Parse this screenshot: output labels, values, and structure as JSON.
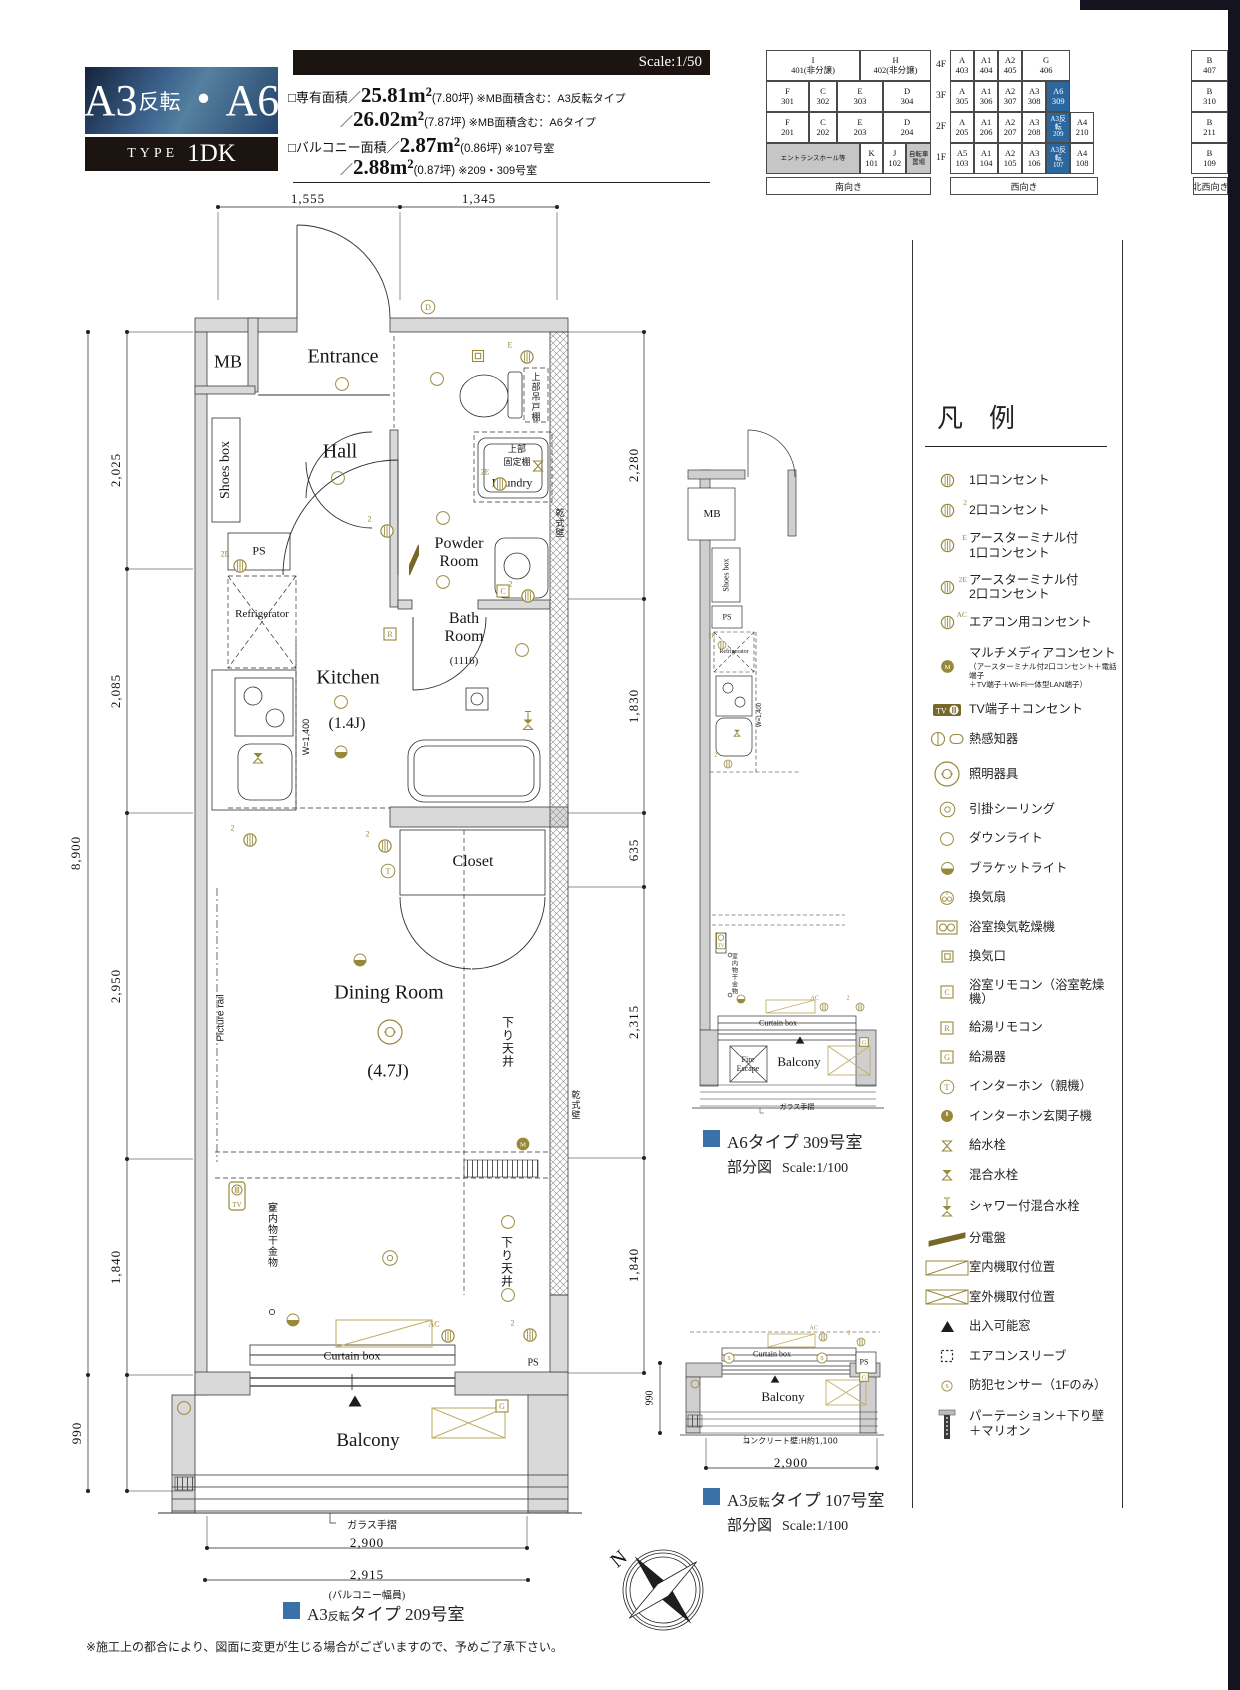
{
  "title": {
    "parts": [
      "A3",
      "反転",
      "・",
      "A6"
    ],
    "type_label": "TYPE",
    "type_value": "1DK"
  },
  "scale_label": "Scale:1/50",
  "areas": [
    {
      "pre": "□専有面積／",
      "big": "25.81m²",
      "par": "(7.80坪)",
      "note": "※MB面積含む：A3反転タイプ",
      "indent": 0
    },
    {
      "pre": "／",
      "big": "26.02m²",
      "par": "(7.87坪)",
      "note": "※MB面積含む：A6タイプ",
      "indent": 52
    },
    {
      "pre": "□バルコニー面積／",
      "big": "2.87m²",
      "par": "(0.86坪)",
      "note": "※107号室",
      "indent": 0
    },
    {
      "pre": "／",
      "big": "2.88m²",
      "par": "(0.87坪)",
      "note": "※209・309号室",
      "indent": 52
    }
  ],
  "building_grid": {
    "floors": [
      "4F",
      "3F",
      "2F",
      "1F"
    ],
    "south_rows": [
      [
        {
          "t": "I",
          "n": "401(非分譲)",
          "w": 57
        },
        {
          "t": "H",
          "n": "402(非分譲)",
          "w": 43
        }
      ],
      [
        {
          "t": "F",
          "n": "301",
          "w": 26
        },
        {
          "t": "C",
          "n": "302",
          "w": 17
        },
        {
          "t": "E",
          "n": "303",
          "w": 28
        },
        {
          "t": "D",
          "n": "304",
          "w": 29
        }
      ],
      [
        {
          "t": "F",
          "n": "201",
          "w": 26
        },
        {
          "t": "C",
          "n": "202",
          "w": 17
        },
        {
          "t": "E",
          "n": "203",
          "w": 28
        },
        {
          "t": "D",
          "n": "204",
          "w": 29
        }
      ],
      [
        {
          "t": "エントランスホール等",
          "n": "",
          "w": 57,
          "g": 1
        },
        {
          "t": "K",
          "n": "101",
          "w": 14
        },
        {
          "t": "J",
          "n": "102",
          "w": 14
        },
        {
          "t": "自転車 置場",
          "n": "",
          "w": 15,
          "g": 1
        }
      ]
    ],
    "west_rows": [
      [
        {
          "t": "A",
          "n": "403",
          "w": 16.7
        },
        {
          "t": "A1",
          "n": "404",
          "w": 16.7
        },
        {
          "t": "A2",
          "n": "405",
          "w": 16.7
        },
        {
          "t": "G",
          "n": "406",
          "w": 33.3
        },
        {
          "t": "",
          "n": "",
          "w": 16.6,
          "e": 1
        }
      ],
      [
        {
          "t": "A",
          "n": "305",
          "w": 16.7
        },
        {
          "t": "A1",
          "n": "306",
          "w": 16.7
        },
        {
          "t": "A2",
          "n": "307",
          "w": 16.7
        },
        {
          "t": "A3",
          "n": "308",
          "w": 16.7
        },
        {
          "t": "A6",
          "n": "309",
          "w": 16.7,
          "h": 1
        },
        {
          "t": "",
          "n": "",
          "w": 16.5,
          "e": 1
        }
      ],
      [
        {
          "t": "A",
          "n": "205",
          "w": 16.7
        },
        {
          "t": "A1",
          "n": "206",
          "w": 16.7
        },
        {
          "t": "A2",
          "n": "207",
          "w": 16.7
        },
        {
          "t": "A3",
          "n": "208",
          "w": 16.7
        },
        {
          "t": "A3反転",
          "n": "209",
          "w": 16.7,
          "h": 1,
          "small": 1
        },
        {
          "t": "A4",
          "n": "210",
          "w": 16.5
        }
      ],
      [
        {
          "t": "A5",
          "n": "103",
          "w": 16.7
        },
        {
          "t": "A1",
          "n": "104",
          "w": 16.7
        },
        {
          "t": "A2",
          "n": "105",
          "w": 16.7
        },
        {
          "t": "A3",
          "n": "106",
          "w": 16.7
        },
        {
          "t": "A3反転",
          "n": "107",
          "w": 16.7,
          "h": 1,
          "small": 1
        },
        {
          "t": "A4",
          "n": "108",
          "w": 16.5
        }
      ]
    ],
    "nw_col": [
      {
        "t": "B",
        "n": "407"
      },
      {
        "t": "B",
        "n": "310"
      },
      {
        "t": "B",
        "n": "211"
      },
      {
        "t": "B",
        "n": "109"
      }
    ],
    "directions": [
      "南向き",
      "西向き",
      "北西向き"
    ]
  },
  "legend": {
    "header": "凡　例",
    "items": [
      {
        "i": "outlet-1-icon",
        "k": "o",
        "label": "1口コンセント"
      },
      {
        "i": "outlet-2-icon",
        "k": "o",
        "s": "2",
        "label": "2口コンセント"
      },
      {
        "i": "outlet-earth-1-icon",
        "k": "o",
        "s": "E",
        "label": "アースターミナル付\n1口コンセント"
      },
      {
        "i": "outlet-earth-2-icon",
        "k": "o",
        "s": "2E",
        "label": "アースターミナル付\n2口コンセント"
      },
      {
        "i": "outlet-aircon-icon",
        "k": "o",
        "s": "AC",
        "label": "エアコン用コンセント"
      },
      {
        "i": "multimedia-outlet-icon",
        "k": "om",
        "t": "M",
        "label": "マルチメディアコンセント",
        "note": "（アースターミナル付2口コンセント＋電話端子\n＋TV端子＋Wi-Fi一体型LAN端子）"
      },
      {
        "i": "tv-outlet-icon",
        "k": "tvh",
        "label": "TV端子＋コンセント"
      },
      {
        "i": "heat-detector-icon",
        "k": "heat",
        "label": "熱感知器"
      },
      {
        "i": "light-fixture-icon",
        "k": "dbl",
        "label": "照明器具"
      },
      {
        "i": "ceiling-hook-icon",
        "k": "dblsm",
        "label": "引掛シーリング"
      },
      {
        "i": "downlight-icon",
        "k": "c",
        "label": "ダウンライト"
      },
      {
        "i": "bracket-light-icon",
        "k": "half",
        "label": "ブラケットライト"
      },
      {
        "i": "vent-fan-icon",
        "k": "fan",
        "label": "換気扇"
      },
      {
        "i": "bath-dryer-icon",
        "k": "bd",
        "label": "浴室換気乾燥機"
      },
      {
        "i": "vent-opening-icon",
        "k": "sqo",
        "label": "換気口"
      },
      {
        "i": "bath-remote-icon",
        "k": "sq",
        "t": "C",
        "label": "浴室リモコン（浴室乾燥機）"
      },
      {
        "i": "water-heater-remote-icon",
        "k": "sq",
        "t": "R",
        "label": "給湯リモコン"
      },
      {
        "i": "water-heater-icon",
        "k": "sq",
        "t": "G",
        "label": "給湯器"
      },
      {
        "i": "intercom-main-icon",
        "k": "oc",
        "t": "T",
        "label": "インターホン（親機）"
      },
      {
        "i": "intercom-entrance-icon",
        "k": "omf",
        "label": "インターホン玄関子機"
      },
      {
        "i": "water-tap-icon",
        "k": "tap",
        "label": "給水栓"
      },
      {
        "i": "mixing-tap-icon",
        "k": "tapf",
        "label": "混合水栓"
      },
      {
        "i": "shower-mixing-tap-icon",
        "k": "shower",
        "label": "シャワー付混合水栓"
      },
      {
        "i": "distribution-board-icon",
        "k": "boardh",
        "label": "分電盤"
      },
      {
        "i": "indoor-unit-icon",
        "k": "indoor",
        "label": "室内機取付位置"
      },
      {
        "i": "outdoor-unit-icon",
        "k": "outdoor",
        "label": "室外機取付位置"
      },
      {
        "i": "accessible-window-icon",
        "k": "tri",
        "label": "出入可能窓"
      },
      {
        "i": "aircon-sleeve-icon",
        "k": "sleeve",
        "label": "エアコンスリーブ"
      },
      {
        "i": "security-sensor-icon",
        "k": "ocs",
        "t": "S",
        "label": "防犯センサー（1Fのみ）"
      },
      {
        "i": "partition-icon",
        "k": "partition",
        "label": "パーテーション＋下り壁\n＋マリオン"
      }
    ]
  },
  "plan_labels": [
    {
      "n": "mb-label",
      "t": "MB",
      "x": 228,
      "y": 362,
      "c": "s18"
    },
    {
      "n": "entrance-label",
      "t": "Entrance",
      "x": 343,
      "y": 357,
      "c": "s20"
    },
    {
      "n": "shoes-box-label",
      "t": "Shoes box",
      "x": 226,
      "y": 470,
      "c": "s14 v"
    },
    {
      "n": "hall-label",
      "t": "Hall",
      "x": 340,
      "y": 452,
      "c": "s20"
    },
    {
      "n": "ps-kitchen-label",
      "t": "PS",
      "x": 259,
      "y": 551,
      "c": "s12"
    },
    {
      "n": "refrigerator-label",
      "t": "Refrigerator",
      "x": 262,
      "y": 614,
      "c": "s11"
    },
    {
      "n": "kitchen-label",
      "t": "Kitchen",
      "x": 348,
      "y": 678,
      "c": "s20"
    },
    {
      "n": "kitchen-size-label",
      "t": "(1.4J)",
      "x": 347,
      "y": 724,
      "c": "s16"
    },
    {
      "n": "kitchen-width-label",
      "t": "W=1,400",
      "x": 306,
      "y": 737,
      "c": "ss9 v"
    },
    {
      "n": "powder-room-label",
      "t": "Powder\nRoom",
      "x": 459,
      "y": 553,
      "c": "s16"
    },
    {
      "n": "laundry-label",
      "t": "Laundry",
      "x": 512,
      "y": 483,
      "c": "s12"
    },
    {
      "n": "upper-fixed-shelf-label",
      "t": "上部\n固定棚",
      "x": 517,
      "y": 455,
      "c": "j9"
    },
    {
      "n": "upper-hanging-shelf-label",
      "t": "上部吊戸棚",
      "x": 535,
      "y": 397,
      "c": "j9 vj"
    },
    {
      "n": "bath-room-label",
      "t": "Bath\nRoom",
      "x": 464,
      "y": 628,
      "c": "s16"
    },
    {
      "n": "bath-size-label",
      "t": "(1116)",
      "x": 464,
      "y": 661,
      "c": "s11"
    },
    {
      "n": "closet-label",
      "t": "Closet",
      "x": 473,
      "y": 862,
      "c": "s16"
    },
    {
      "n": "dining-room-label",
      "t": "Dining Room",
      "x": 389,
      "y": 993,
      "c": "s20"
    },
    {
      "n": "dining-size-label",
      "t": "(4.7J)",
      "x": 388,
      "y": 1071,
      "c": "s18"
    },
    {
      "n": "drop-ceiling-1-label",
      "t": "下り天井",
      "x": 508,
      "y": 1042,
      "c": "j12 vj"
    },
    {
      "n": "drop-ceiling-2-label",
      "t": "下り天井",
      "x": 507,
      "y": 1262,
      "c": "j12 vj"
    },
    {
      "n": "dry-wall-1-label",
      "t": "乾式壁",
      "x": 559,
      "y": 523,
      "c": "j9 vj"
    },
    {
      "n": "dry-wall-2-label",
      "t": "乾式壁",
      "x": 575,
      "y": 1105,
      "c": "j9 vj"
    },
    {
      "n": "picture-rail-label",
      "t": "Picture rail",
      "x": 221,
      "y": 1018,
      "c": "ss10 v"
    },
    {
      "n": "indoor-hanger-label",
      "t": "室内物干金物",
      "x": 271,
      "y": 1235,
      "c": "j10 vj"
    },
    {
      "n": "curtain-box-label",
      "t": "Curtain box",
      "x": 352,
      "y": 1356,
      "c": "s12"
    },
    {
      "n": "ps-balcony-label",
      "t": "PS",
      "x": 533,
      "y": 1363,
      "c": "s10"
    },
    {
      "n": "balcony-label",
      "t": "Balcony",
      "x": 368,
      "y": 1441,
      "c": "s19"
    },
    {
      "n": "glass-rail-label",
      "t": "ガラス手摺",
      "x": 372,
      "y": 1524,
      "c": "j10"
    },
    {
      "n": "a6-mb-label",
      "t": "MB",
      "x": 712,
      "y": 514,
      "c": "s11"
    },
    {
      "n": "a6-shoes-box-label",
      "t": "Shoes box",
      "x": 726,
      "y": 575,
      "c": "s8 v"
    },
    {
      "n": "a6-ps-label",
      "t": "PS",
      "x": 727,
      "y": 617,
      "c": "s8"
    },
    {
      "n": "a6-refrigerator-label",
      "t": "Refrigerator",
      "x": 734,
      "y": 652,
      "c": "s6"
    },
    {
      "n": "a6-kitchen-width-label",
      "t": "W=1,400",
      "x": 760,
      "y": 715,
      "c": "ss6 v"
    },
    {
      "n": "a6-indoor-hanger-label",
      "t": "室内物干金物",
      "x": 734,
      "y": 974,
      "c": "j6 vj"
    },
    {
      "n": "a6-curtain-box-label",
      "t": "Curtain box",
      "x": 778,
      "y": 1023,
      "c": "s8"
    },
    {
      "n": "a6-fire-escape-label",
      "t": "Fire\nEscape",
      "x": 748,
      "y": 1064,
      "c": "s8"
    },
    {
      "n": "a6-balcony-label",
      "t": "Balcony",
      "x": 799,
      "y": 1062,
      "c": "s13"
    },
    {
      "n": "a6-glass-rail-label",
      "t": "ガラス手摺",
      "x": 797,
      "y": 1107,
      "c": "j7"
    },
    {
      "n": "p107-curtain-box-label",
      "t": "Curtain box",
      "x": 772,
      "y": 1354,
      "c": "s8"
    },
    {
      "n": "p107-ps-label",
      "t": "PS",
      "x": 864,
      "y": 1362,
      "c": "s8"
    },
    {
      "n": "p107-balcony-label",
      "t": "Balcony",
      "x": 783,
      "y": 1397,
      "c": "s13"
    },
    {
      "n": "p107-concrete-label",
      "t": "コンクリート壁:H約1,100",
      "x": 790,
      "y": 1441,
      "c": "j8"
    }
  ],
  "dims": [
    {
      "t": "1,555",
      "x": 308,
      "y": 199
    },
    {
      "t": "1,345",
      "x": 479,
      "y": 199
    },
    {
      "t": "2,025",
      "x": 116,
      "y": 470,
      "v": 1
    },
    {
      "t": "2,085",
      "x": 116,
      "y": 691,
      "v": 1
    },
    {
      "t": "2,950",
      "x": 116,
      "y": 986,
      "v": 1
    },
    {
      "t": "1,840",
      "x": 116,
      "y": 1267,
      "v": 1
    },
    {
      "t": "990",
      "x": 77,
      "y": 1433,
      "v": 1
    },
    {
      "t": "8,900",
      "x": 76,
      "y": 853,
      "v": 1
    },
    {
      "t": "2,280",
      "x": 634,
      "y": 465,
      "v": 1
    },
    {
      "t": "1,830",
      "x": 634,
      "y": 706,
      "v": 1
    },
    {
      "t": "635",
      "x": 634,
      "y": 850,
      "v": 1
    },
    {
      "t": "2,315",
      "x": 634,
      "y": 1022,
      "v": 1
    },
    {
      "t": "1,840",
      "x": 634,
      "y": 1265,
      "v": 1
    },
    {
      "t": "2,900",
      "x": 367,
      "y": 1543
    },
    {
      "t": "2,915",
      "x": 367,
      "y": 1575
    },
    {
      "t": "(バルコニー幅員)",
      "x": 367,
      "y": 1594,
      "sm": 1
    },
    {
      "t": "990",
      "x": 650,
      "y": 1398,
      "v": 1,
      "sm": 1
    },
    {
      "t": "2,900",
      "x": 791,
      "y": 1463
    }
  ],
  "symbols": [
    {
      "k": "oc",
      "t": "D",
      "x": 428,
      "y": 307
    },
    {
      "k": "o",
      "s": "E",
      "x": 527,
      "y": 357
    },
    {
      "k": "c",
      "x": 342,
      "y": 384
    },
    {
      "k": "c",
      "x": 437,
      "y": 379
    },
    {
      "k": "sqo",
      "x": 478,
      "y": 356
    },
    {
      "k": "c",
      "x": 338,
      "y": 478
    },
    {
      "k": "o",
      "s": "2",
      "x": 387,
      "y": 531
    },
    {
      "k": "board",
      "x": 414,
      "y": 558
    },
    {
      "k": "c",
      "x": 443,
      "y": 518
    },
    {
      "k": "c",
      "x": 443,
      "y": 582
    },
    {
      "k": "o",
      "s": "2E",
      "x": 500,
      "y": 484
    },
    {
      "k": "tap",
      "x": 538,
      "y": 466
    },
    {
      "k": "sq",
      "t": "C",
      "x": 503,
      "y": 591
    },
    {
      "k": "o",
      "s": "2",
      "x": 528,
      "y": 596
    },
    {
      "k": "sq",
      "t": "R",
      "x": 390,
      "y": 634
    },
    {
      "k": "c",
      "x": 522,
      "y": 650
    },
    {
      "k": "shower",
      "x": 528,
      "y": 720
    },
    {
      "k": "o",
      "s": "2E",
      "x": 240,
      "y": 566
    },
    {
      "k": "c",
      "x": 341,
      "y": 702
    },
    {
      "k": "half",
      "x": 341,
      "y": 752
    },
    {
      "k": "tapf",
      "x": 258,
      "y": 758
    },
    {
      "k": "o",
      "s": "2",
      "x": 250,
      "y": 840
    },
    {
      "k": "o",
      "s": "2",
      "x": 385,
      "y": 846
    },
    {
      "k": "oc",
      "t": "T",
      "x": 388,
      "y": 871
    },
    {
      "k": "half",
      "x": 360,
      "y": 960
    },
    {
      "k": "dbl",
      "x": 390,
      "y": 1032
    },
    {
      "k": "om",
      "t": "M",
      "x": 523,
      "y": 1144
    },
    {
      "k": "tvbox",
      "x": 237,
      "y": 1196
    },
    {
      "k": "dblsm",
      "x": 390,
      "y": 1258
    },
    {
      "k": "c",
      "x": 508,
      "y": 1222
    },
    {
      "k": "c",
      "x": 508,
      "y": 1295
    },
    {
      "k": "hook",
      "x": 272,
      "y": 1208
    },
    {
      "k": "hook",
      "x": 272,
      "y": 1312
    },
    {
      "k": "half",
      "x": 293,
      "y": 1320
    },
    {
      "k": "o",
      "s": "AC",
      "x": 448,
      "y": 1336
    },
    {
      "k": "o",
      "s": "2",
      "x": 530,
      "y": 1335
    },
    {
      "k": "sq",
      "t": "G",
      "x": 502,
      "y": 1406
    },
    {
      "k": "c",
      "x": 184,
      "y": 1408
    },
    {
      "k": "tri",
      "x": 355,
      "y": 1401
    },
    {
      "k": "o2",
      "s": "2E",
      "x": 722,
      "y": 645
    },
    {
      "k": "tapf2",
      "x": 737,
      "y": 733
    },
    {
      "k": "o2",
      "s": "2",
      "x": 728,
      "y": 764
    },
    {
      "k": "tvbox2",
      "x": 721,
      "y": 941
    },
    {
      "k": "hook2",
      "x": 730,
      "y": 955
    },
    {
      "k": "hook2",
      "x": 730,
      "y": 995
    },
    {
      "k": "half2",
      "x": 741,
      "y": 999
    },
    {
      "k": "o2",
      "s": "AC",
      "x": 824,
      "y": 1007
    },
    {
      "k": "o2",
      "s": "2",
      "x": 860,
      "y": 1007
    },
    {
      "k": "tri2",
      "x": 800,
      "y": 1040
    },
    {
      "k": "sq2",
      "t": "G",
      "x": 864,
      "y": 1042
    },
    {
      "k": "o2",
      "s": "AC",
      "x": 823,
      "y": 1337
    },
    {
      "k": "o2",
      "s": "2",
      "x": 861,
      "y": 1342
    },
    {
      "k": "ocs",
      "t": "S",
      "x": 729,
      "y": 1358
    },
    {
      "k": "ocs",
      "t": "S",
      "x": 822,
      "y": 1358
    },
    {
      "k": "tri2",
      "x": 775,
      "y": 1379
    },
    {
      "k": "sq2",
      "t": "G",
      "x": 864,
      "y": 1377
    },
    {
      "k": "c2",
      "x": 695,
      "y": 1384
    }
  ],
  "captions": {
    "main": {
      "p1": "A3",
      "p2": "反転",
      "p3": "タイプ 209号室"
    },
    "a6": {
      "line1": "A6タイプ 309号室",
      "line2": "部分図",
      "scale": "Scale:1/100"
    },
    "p107": {
      "p1": "A3",
      "p2": "反転",
      "p3": "タイプ 107号室",
      "line2": "部分図",
      "scale": "Scale:1/100"
    }
  },
  "compass": {
    "n": "N"
  },
  "footnote": "※施工上の都合により、図面に変更が生じる場合がございますので、予めご了承下さい。"
}
